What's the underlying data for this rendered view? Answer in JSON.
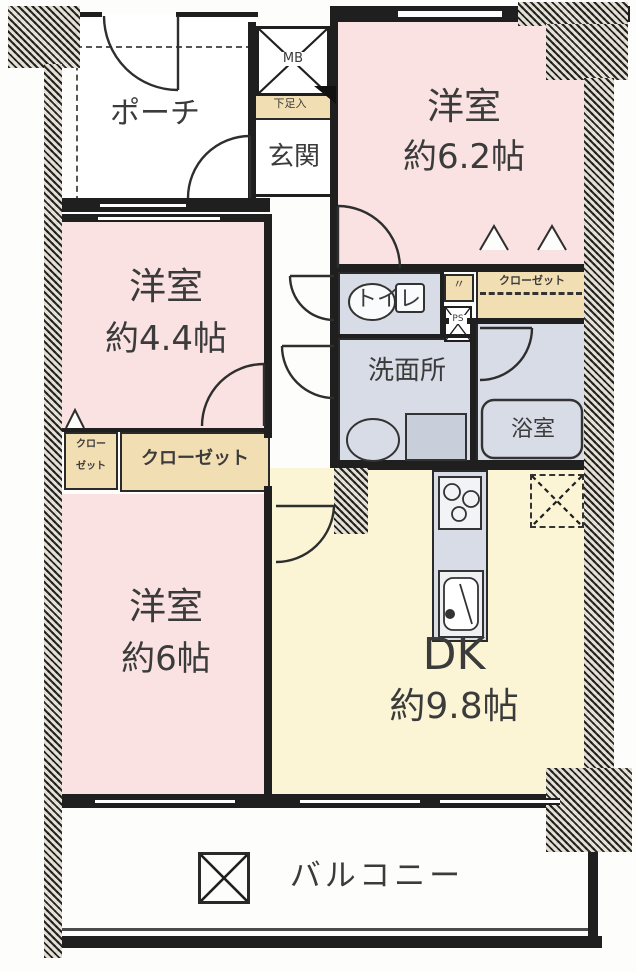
{
  "rooms": {
    "porch": {
      "label": "ポーチ"
    },
    "entrance": {
      "label": "玄関"
    },
    "shoe_box": {
      "label": "下足入"
    },
    "meter_box": {
      "label": "MB"
    },
    "pipe_space": {
      "label": "PS"
    },
    "ditto_mark": {
      "label": "〃"
    },
    "toilet": {
      "label": "トイレ"
    },
    "washroom": {
      "label": "洗面所"
    },
    "bathroom": {
      "label": "浴室"
    },
    "closet_top": {
      "label": "クローゼット"
    },
    "closet_mid": {
      "label": "クローゼット"
    },
    "closet_small": {
      "line1": "クロー",
      "line2": "ゼット"
    },
    "room62": {
      "name": "洋室",
      "size": "約6.2帖"
    },
    "room44": {
      "name": "洋室",
      "size": "約4.4帖"
    },
    "room6": {
      "name": "洋室",
      "size": "約6帖"
    },
    "dk": {
      "name": "DK",
      "size": "約9.8帖"
    },
    "balcony": {
      "label": "バルコニー"
    }
  },
  "colors": {
    "wall": "#1f1f1f",
    "room_pink": "#f9e2e1",
    "dk_yellow": "#fbf5d6",
    "closet_tan": "#f2deb3",
    "wet_gray": "#d8dce6",
    "label_ink": "#3b3b3b"
  }
}
